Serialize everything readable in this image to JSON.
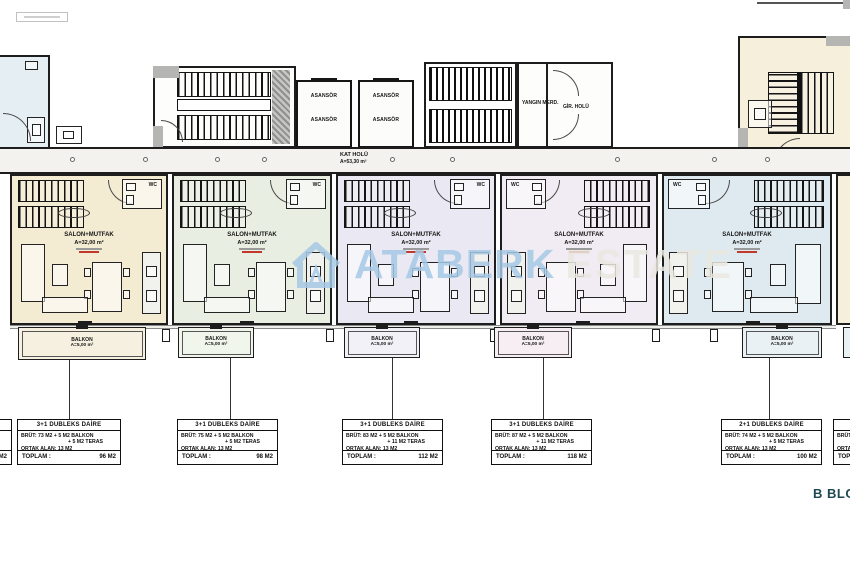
{
  "plan": {
    "block_title": "B BLOK",
    "corridor": {
      "label": "KAT HOLÜ",
      "area": "A=53,30 m²"
    },
    "elevator": {
      "label": "ASANSÖR"
    },
    "fire_stairs": {
      "label": "YANGIN MERD."
    },
    "entrance_hall": {
      "label": "GİR. HOLÜ"
    },
    "colors": {
      "wall": "#1d1d1d",
      "corridor_fill": "#f3f2ee",
      "fragment_fill": "#f6efdc",
      "title_color": "#1f4a52"
    }
  },
  "watermark": {
    "brand": "ATABERK",
    "brand_suffix": "ESTATE",
    "brand_color": "#a6c9e5",
    "suffix_color": "#eae8e1",
    "logo": "house-outline-icon"
  },
  "units": [
    {
      "id": "1",
      "room_label": "SALON+MUTFAK",
      "room_area": "A=32,00 m²",
      "wc_label": "WC",
      "balcony_label": "BALKON",
      "balcony_area": "A=5,00 m²",
      "color": "#f3ebd2",
      "balcony_color": "#f6f0e0"
    },
    {
      "id": "2",
      "room_label": "SALON+MUTFAK",
      "room_area": "A=32,00 m²",
      "wc_label": "WC",
      "balcony_label": "BALKON",
      "balcony_area": "A=5,00 m²",
      "color": "#e8efe2",
      "balcony_color": "#f1f6ec"
    },
    {
      "id": "3",
      "room_label": "SALON+MUTFAK",
      "room_area": "A=32,00 m²",
      "wc_label": "WC",
      "balcony_label": "BALKON",
      "balcony_area": "A=5,00 m²",
      "color": "#eae9f3",
      "balcony_color": "#f2f1f8"
    },
    {
      "id": "4",
      "room_label": "SALON+MUTFAK",
      "room_area": "A=32,00 m²",
      "wc_label": "WC",
      "balcony_label": "BALKON",
      "balcony_area": "A=5,00 m²",
      "color": "#f1ebf3",
      "balcony_color": "#f6eef2"
    },
    {
      "id": "5",
      "room_label": "SALON+MUTFAK",
      "room_area": "A=32,00 m²",
      "wc_label": "WC",
      "balcony_label": "BALKON",
      "balcony_area": "A=5,00 m²",
      "color": "#dfeaf0",
      "balcony_color": "#eaf1f5"
    }
  ],
  "info_boxes": [
    {
      "type": "3+1 DUBLEKS DAİRE",
      "line1": "BRÜT: 73 M2 + 5 M2 BALKON",
      "line2": "+ 5 M2 TERAS",
      "line3": "ORTAK ALAN: 13 M2",
      "total_label": "TOPLAM :",
      "total_value": "96 M2"
    },
    {
      "type": "3+1 DUBLEKS DAİRE",
      "line1": "BRÜT: 75 M2 + 5 M2 BALKON",
      "line2": "+ 5 M2 TERAS",
      "line3": "ORTAK ALAN: 13 M2",
      "total_label": "TOPLAM :",
      "total_value": "98 M2"
    },
    {
      "type": "3+1 DUBLEKS DAİRE",
      "line1": "BRÜT: 83 M2 + 5 M2 BALKON",
      "line2": "+ 11 M2 TERAS",
      "line3": "ORTAK ALAN: 13 M2",
      "total_label": "TOPLAM :",
      "total_value": "112 M2"
    },
    {
      "type": "3+1 DUBLEKS DAİRE",
      "line1": "BRÜT: 87 M2 + 5 M2 BALKON",
      "line2": "+ 11 M2 TERAS",
      "line3": "ORTAK ALAN: 13 M2",
      "total_label": "TOPLAM :",
      "total_value": "118 M2"
    },
    {
      "type": "2+1 DUBLEKS DAİRE",
      "line1": "BRÜT: 74 M2 + 5 M2 BALKON",
      "line2": "+ 5 M2 TERAS",
      "line3": "ORTAK ALAN: 13 M2",
      "total_label": "TOPLAM :",
      "total_value": "100 M2"
    }
  ],
  "partials": {
    "left_value": "M2",
    "right_line1": "BRÜT:",
    "right_line3": "ORTAK",
    "right_total": "TOPLAM"
  }
}
